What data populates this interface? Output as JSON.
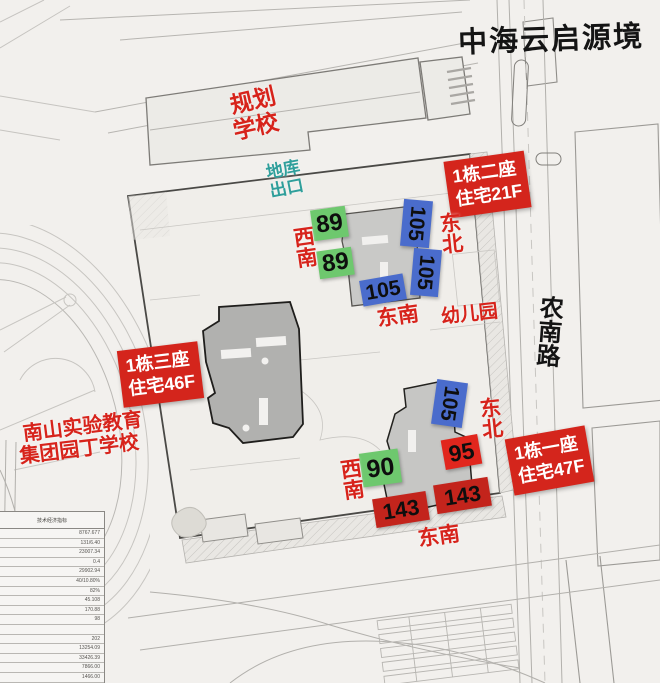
{
  "title": "中海云启源境",
  "places": {
    "school_plan": {
      "line1": "规划",
      "line2": "学校"
    },
    "garage_exit": {
      "line1": "地库",
      "line2": "出口"
    },
    "kindergarten": "幼儿园",
    "road_name": "农南路",
    "south_school": {
      "line1": "南山实验教育",
      "line2": "集团园丁学校"
    }
  },
  "tower_tags": [
    {
      "line1": "1栋二座",
      "line2": "住宅21F"
    },
    {
      "line1": "1栋三座",
      "line2": "住宅46F"
    },
    {
      "line1": "1栋一座",
      "line2": "住宅47F"
    }
  ],
  "units": {
    "b2_89_a": "89",
    "b2_89_b": "89",
    "b2_105_a": "105",
    "b2_105_b": "105",
    "b2_105_c": "105",
    "b1_105": "105",
    "b1_95": "95",
    "b1_90": "90",
    "b1_143_a": "143",
    "b1_143_b": "143"
  },
  "directions": {
    "upper_sw": "西南",
    "upper_ne": "东北",
    "upper_se": "东南",
    "lower_ne": "东北",
    "lower_sw": "西南",
    "lower_se": "东南"
  },
  "colors": {
    "label_red": "#d7231b",
    "tag_red": "#d4251c",
    "unit_green": "#6ec86e",
    "unit_blue": "#4a6ccc",
    "unit_red": "#e1261d",
    "unit_dark_red": "#c3241c",
    "garage_teal": "#2f9f9b",
    "title_black": "#141414"
  },
  "stats_table": {
    "header": "技术经济指标",
    "rows": [
      "8767.677",
      "131/6.40",
      "23007.34",
      "0.4",
      "29902.94",
      "40/10.80%",
      "82%",
      "45.108",
      "170.88",
      "98",
      "",
      "202",
      "13254.09",
      "33426.39",
      "7866.00",
      "1466.00",
      "785.00"
    ]
  }
}
